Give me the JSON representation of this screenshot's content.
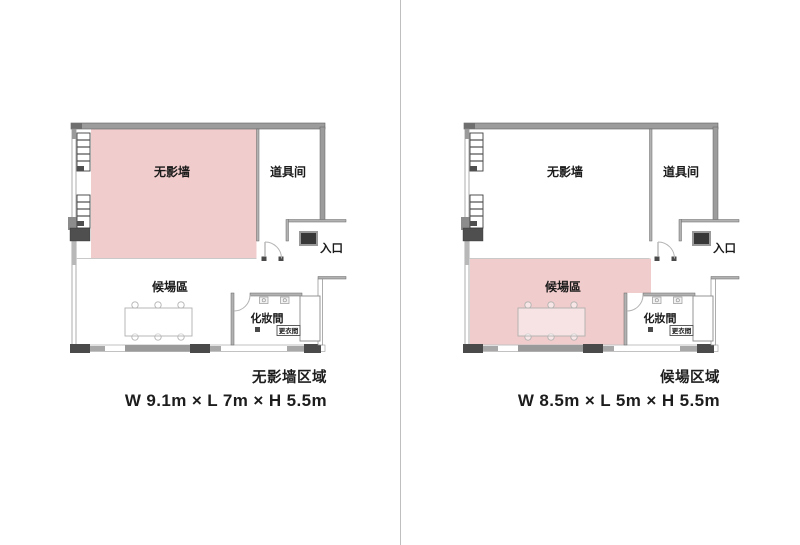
{
  "colors": {
    "highlight": "#f1cccc",
    "panel_divider": "#bfbfbf",
    "wall_gray": "#9c9c9c",
    "wall_dark": "#4a4a4a",
    "label": "#1a1a1a"
  },
  "rooms": {
    "studio": "无影墙",
    "props": "道具间",
    "waiting": "候場區",
    "makeup": "化妝間",
    "changing": "更衣間",
    "entrance": "入口"
  },
  "plans": [
    {
      "id": "studio-zone-plan",
      "highlighted_zone": "studio",
      "caption_title": "无影墙区域",
      "caption_dims": "W 9.1m × L 7m × H 5.5m"
    },
    {
      "id": "waiting-zone-plan",
      "highlighted_zone": "waiting",
      "caption_title": "候場区域",
      "caption_dims": "W 8.5m × L 5m × H 5.5m"
    }
  ]
}
